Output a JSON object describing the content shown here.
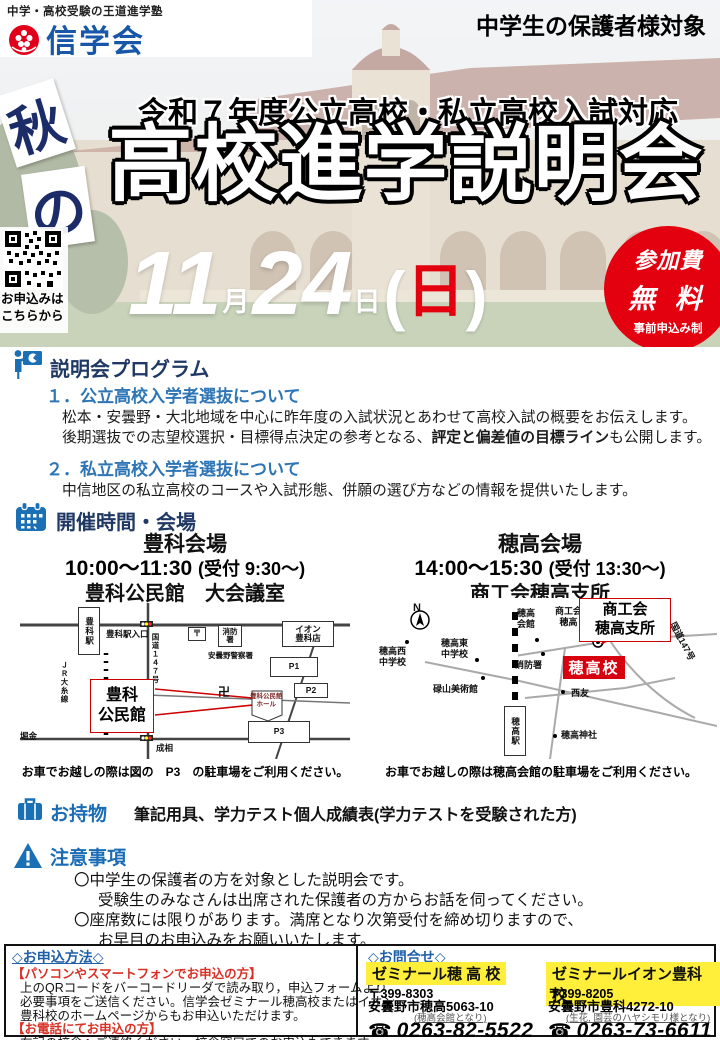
{
  "colors": {
    "accent_red": "#e3000f",
    "brand_blue": "#1857a8",
    "navy": "#1f3864",
    "section_blue": "#1b6cb5",
    "item_blue": "#2e75b6",
    "highlight_yellow": "#ffef3b",
    "map_red": "#cc0000"
  },
  "meta": {
    "tagline": "中学・高校受験の王道進学塾",
    "brand": "信学会",
    "audience": "中学生の保護者様対象"
  },
  "hero": {
    "season_top": "秋",
    "season_bottom": "の",
    "subtitle": "令和７年度公立高校・私立高校入試対応",
    "title": "高校進学説明会",
    "qr_caption": "お申込みは\nこちらから",
    "date": {
      "month": "11",
      "month_unit": "月",
      "day": "24",
      "day_unit": "日",
      "open": "(",
      "weekday": "日",
      "close": ")"
    },
    "fee_badge": {
      "line1": "参加費",
      "line2": "無 料",
      "line3": "事前申込み制"
    }
  },
  "program": {
    "heading": "説明会プログラム",
    "items": [
      {
        "title": "１．公立高校入学者選抜について",
        "line1": "松本・安曇野・大北地域を中心に昨年度の入試状況とあわせて高校入試の概要をお伝えします。",
        "line2_pre": "後期選抜での志望校選択・目標得点決定の参考となる、",
        "line2_bold": "評定と偏差値の目標ライン",
        "line2_post": "も公開します。"
      },
      {
        "title": "２．私立高校入学者選抜について",
        "line1": "中信地区の私立高校のコースや入試形態、併願の選び方などの情報を提供いたします。"
      }
    ]
  },
  "schedule": {
    "heading": "開催時間・会場",
    "venues": [
      {
        "name": "豊科会場",
        "time": "10:00～11:30",
        "reception": "(受付  9:30～)",
        "place": "豊科公民館　大会議室",
        "caption": "お車でお越しの際は図の　P3　の駐車場をご利用ください。"
      },
      {
        "name": "穂高会場",
        "time": "14:00～15:30",
        "reception": "(受付  13:30～)",
        "place": "商工会穂高支所",
        "caption": "お車でお越しの際は穂高会館の駐車場をご利用ください。"
      }
    ]
  },
  "maps": {
    "toyoshina": {
      "station": "豊科駅",
      "jr_line": "ＪＲ大糸線",
      "route": "国道１４７号",
      "station_entrance": "豊科駅入口",
      "post_office": "〒",
      "fire_station": "消防\n署",
      "police": "安曇野警察署",
      "aeon": "イオン\n豊科店",
      "p1": "P1",
      "p2": "P2",
      "p3": "P3",
      "temple": "卍",
      "hall_note": "豊科公民館\nホール",
      "callout": "豊科\n公民館",
      "horikane": "堀金",
      "narisai": "成相"
    },
    "hotaka": {
      "north": "N",
      "nishi_jhs": "穂高西\n中学校",
      "higashi_jhs": "穂高東\n中学校",
      "rokuzan_museum": "碌山美術館",
      "kaikan": "穂高\n会館",
      "shokokai": "商工会\n穂高",
      "fire_station": "消防署",
      "hotaka_school": "穂高校",
      "seiyu": "西友",
      "shrine": "穂高神社",
      "route": "国道147号",
      "station": "穂高駅",
      "callout": "商工会\n穂高支所"
    }
  },
  "belongings": {
    "heading": "お持物",
    "text": "筆記用具、学力テスト個人成績表(学力テストを受験された方)"
  },
  "notes": {
    "heading": "注意事項",
    "lines": [
      "〇中学生の保護者の方を対象とした説明会です。",
      "受験生のみなさんは出席された保護者の方からお話を伺ってください。",
      "〇座席数には限りがあります。満席となり次第受付を締め切りますので、",
      "お早目のお申込みをお願いいたします。"
    ]
  },
  "apply": {
    "heading": "◇お申込方法◇",
    "web_label": "【パソコンやスマートフォンでお申込の方】",
    "web_lines": [
      "上のQRコードをバーコードリーダで読み取り，申込フォームより",
      "必要事項をご送信ください。信学会ゼミナール穂高校またはイオン",
      "豊科校のホームページからもお申込いただけます。"
    ],
    "tel_label": "【お電話にてお申込の方】",
    "tel_line": "右記の校舎へご連絡ください。校舎窓口でのお申込もできます。"
  },
  "contact": {
    "heading": "◇お問合せ◇",
    "phone_glyph": "☎",
    "offices": [
      {
        "name": "ゼミナール穂 高 校",
        "postal": "〒399-8303",
        "address": "安曇野市穂高5063-10",
        "note": "(穂高会館となり)",
        "tel": "0263-82-5522"
      },
      {
        "name": "ゼミナールイオン豊科校",
        "postal": "〒399-8205",
        "address": "安曇野市豊科4272-10",
        "note": "(生花, 園芸のハヤシモリ様となり)",
        "tel": "0263-73-6611"
      }
    ]
  }
}
